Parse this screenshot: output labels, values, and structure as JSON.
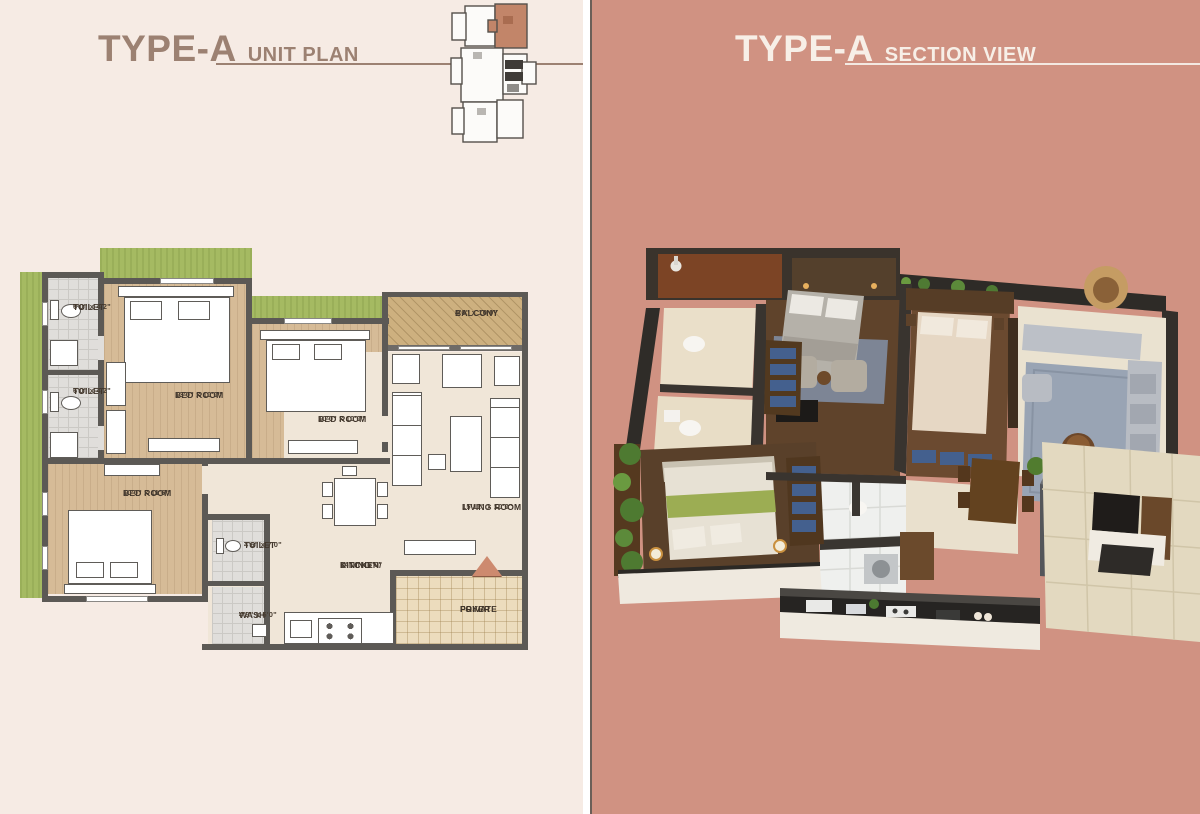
{
  "left": {
    "title": "TYPE-A",
    "subtitle": "UNIT PLAN",
    "rooms": {
      "toilet_a": {
        "name": "TOILET",
        "dims": "6'0\" x 4'2\""
      },
      "toilet_b": {
        "name": "TOILET",
        "dims": "6'0\" x 4'2\""
      },
      "bedroom_1": {
        "name": "BED ROOM",
        "dims": "13'0\" x 10'0\""
      },
      "bedroom_2": {
        "name": "BED ROOM",
        "dims": "10'0\" x 10'0\""
      },
      "balcony": {
        "name": "BALCONY",
        "dims": "4'0\" x 10'0\""
      },
      "bedroom_3": {
        "name": "BED ROOM",
        "dims": "10'0\" x 11'6\""
      },
      "toilet_c": {
        "name": "TOILET",
        "dims": "4'6\" x 7'0\""
      },
      "wash": {
        "name": "WASH",
        "dims": "4'9\" x 5'0\""
      },
      "living": {
        "name": "LIVING ROOM",
        "dims": "15'11\" x 10'0\""
      },
      "kitchen": {
        "name": "KITCHEN/",
        "name2": "DINING",
        "dims": "14'0\" x 8'0\""
      },
      "foyer": {
        "name": "PRIVATE",
        "name2": "FOYER"
      }
    }
  },
  "right": {
    "title": "TYPE-A",
    "subtitle": "SECTION VIEW"
  },
  "colors": {
    "left_bg": "#f6ebe4",
    "right_bg": "#d09282",
    "title_brown": "#9c8172",
    "title_light": "#f7efe7",
    "wall": "#5c5955",
    "keyplan_unit_highlight": "#c28569",
    "entry_arrow": "#cd8a6f"
  }
}
